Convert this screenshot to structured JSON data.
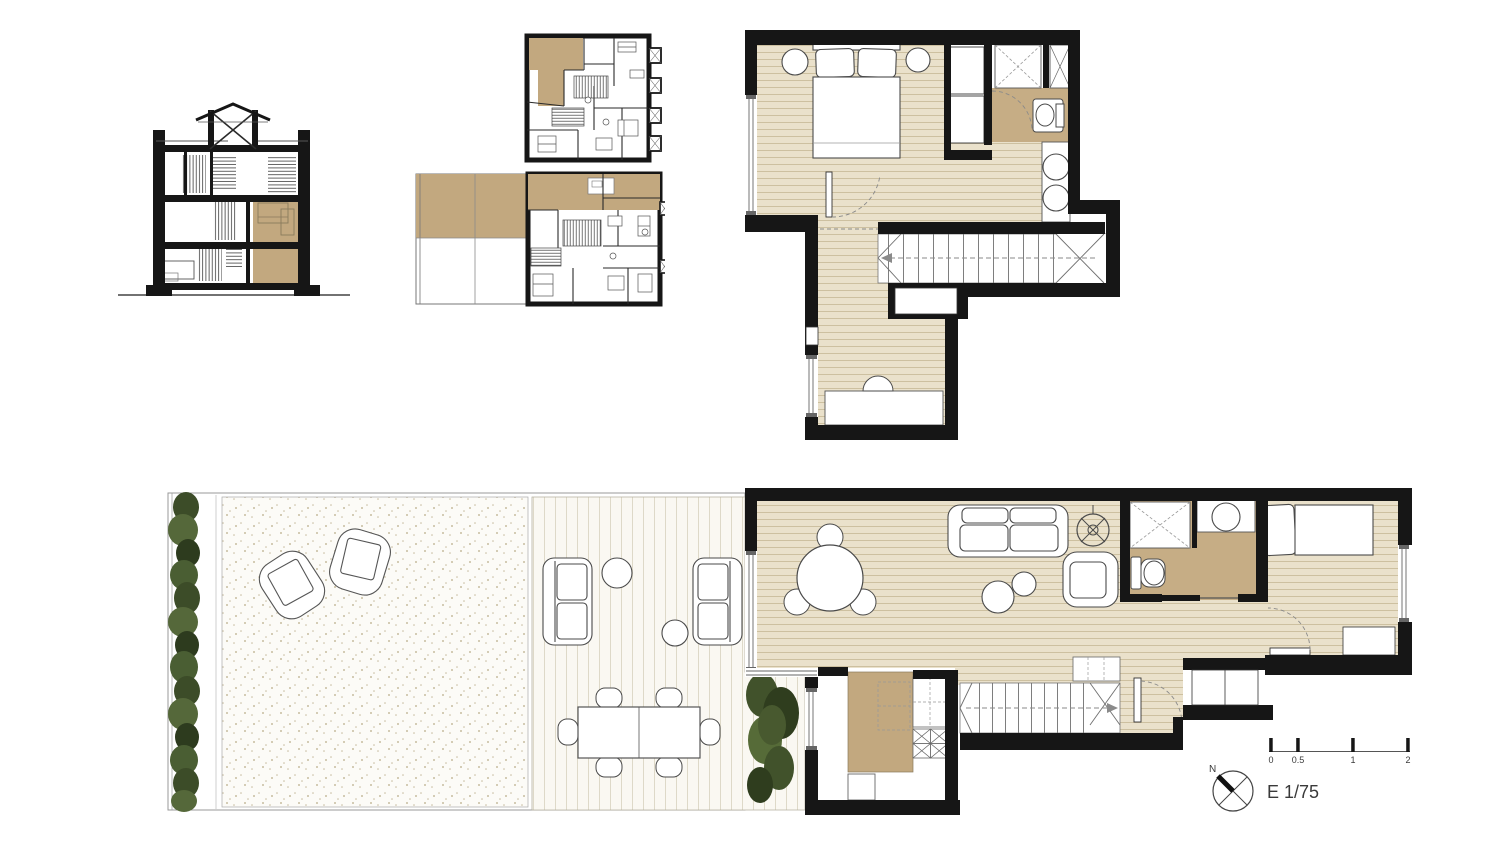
{
  "document": {
    "type": "architectural drawing",
    "title": "Duplex apartment — plans, section and key plans"
  },
  "legend": {
    "north_label": "N",
    "scale_label": "E 1/75",
    "scale_bar_ticks": [
      "0",
      "0.5",
      "1",
      "2"
    ]
  },
  "panels": [
    {
      "id": "building-section",
      "description": "Cross section of four-level house with roof lantern, stair core and highlighted duplex rooms"
    },
    {
      "id": "key-plan-upper-level",
      "description": "Small key plan of upper level, duplex unit highlighted in tan"
    },
    {
      "id": "key-plan-ground-level",
      "description": "Small key plan of ground level with terrace, duplex unit highlighted in tan"
    },
    {
      "id": "upper-floor-plan",
      "description": "Bedroom suite: double bed, nightstands, wardrobe, showers, WC, double washbasin, stair down, study desk"
    },
    {
      "id": "ground-floor-plan",
      "description": "Garden with hedge and gravel patio, timber deck with outdoor lounge and dining table, living-dining room, stove, bathroom, kitchen, stair, hallway and single bedroom"
    }
  ],
  "colors": {
    "wall": "#161616",
    "wood_floor": "#eae1cb",
    "wood_stripe": "#cdc0a0",
    "highlight_tan": "#c2a87f",
    "deck": "#faf8f2",
    "deck_stripe": "#ded9c8",
    "gravel_dot": "#c8bda0",
    "hedge_green": "#3c4c28",
    "tree_green": "#41522b",
    "furniture_line": "#4a4a4a"
  }
}
